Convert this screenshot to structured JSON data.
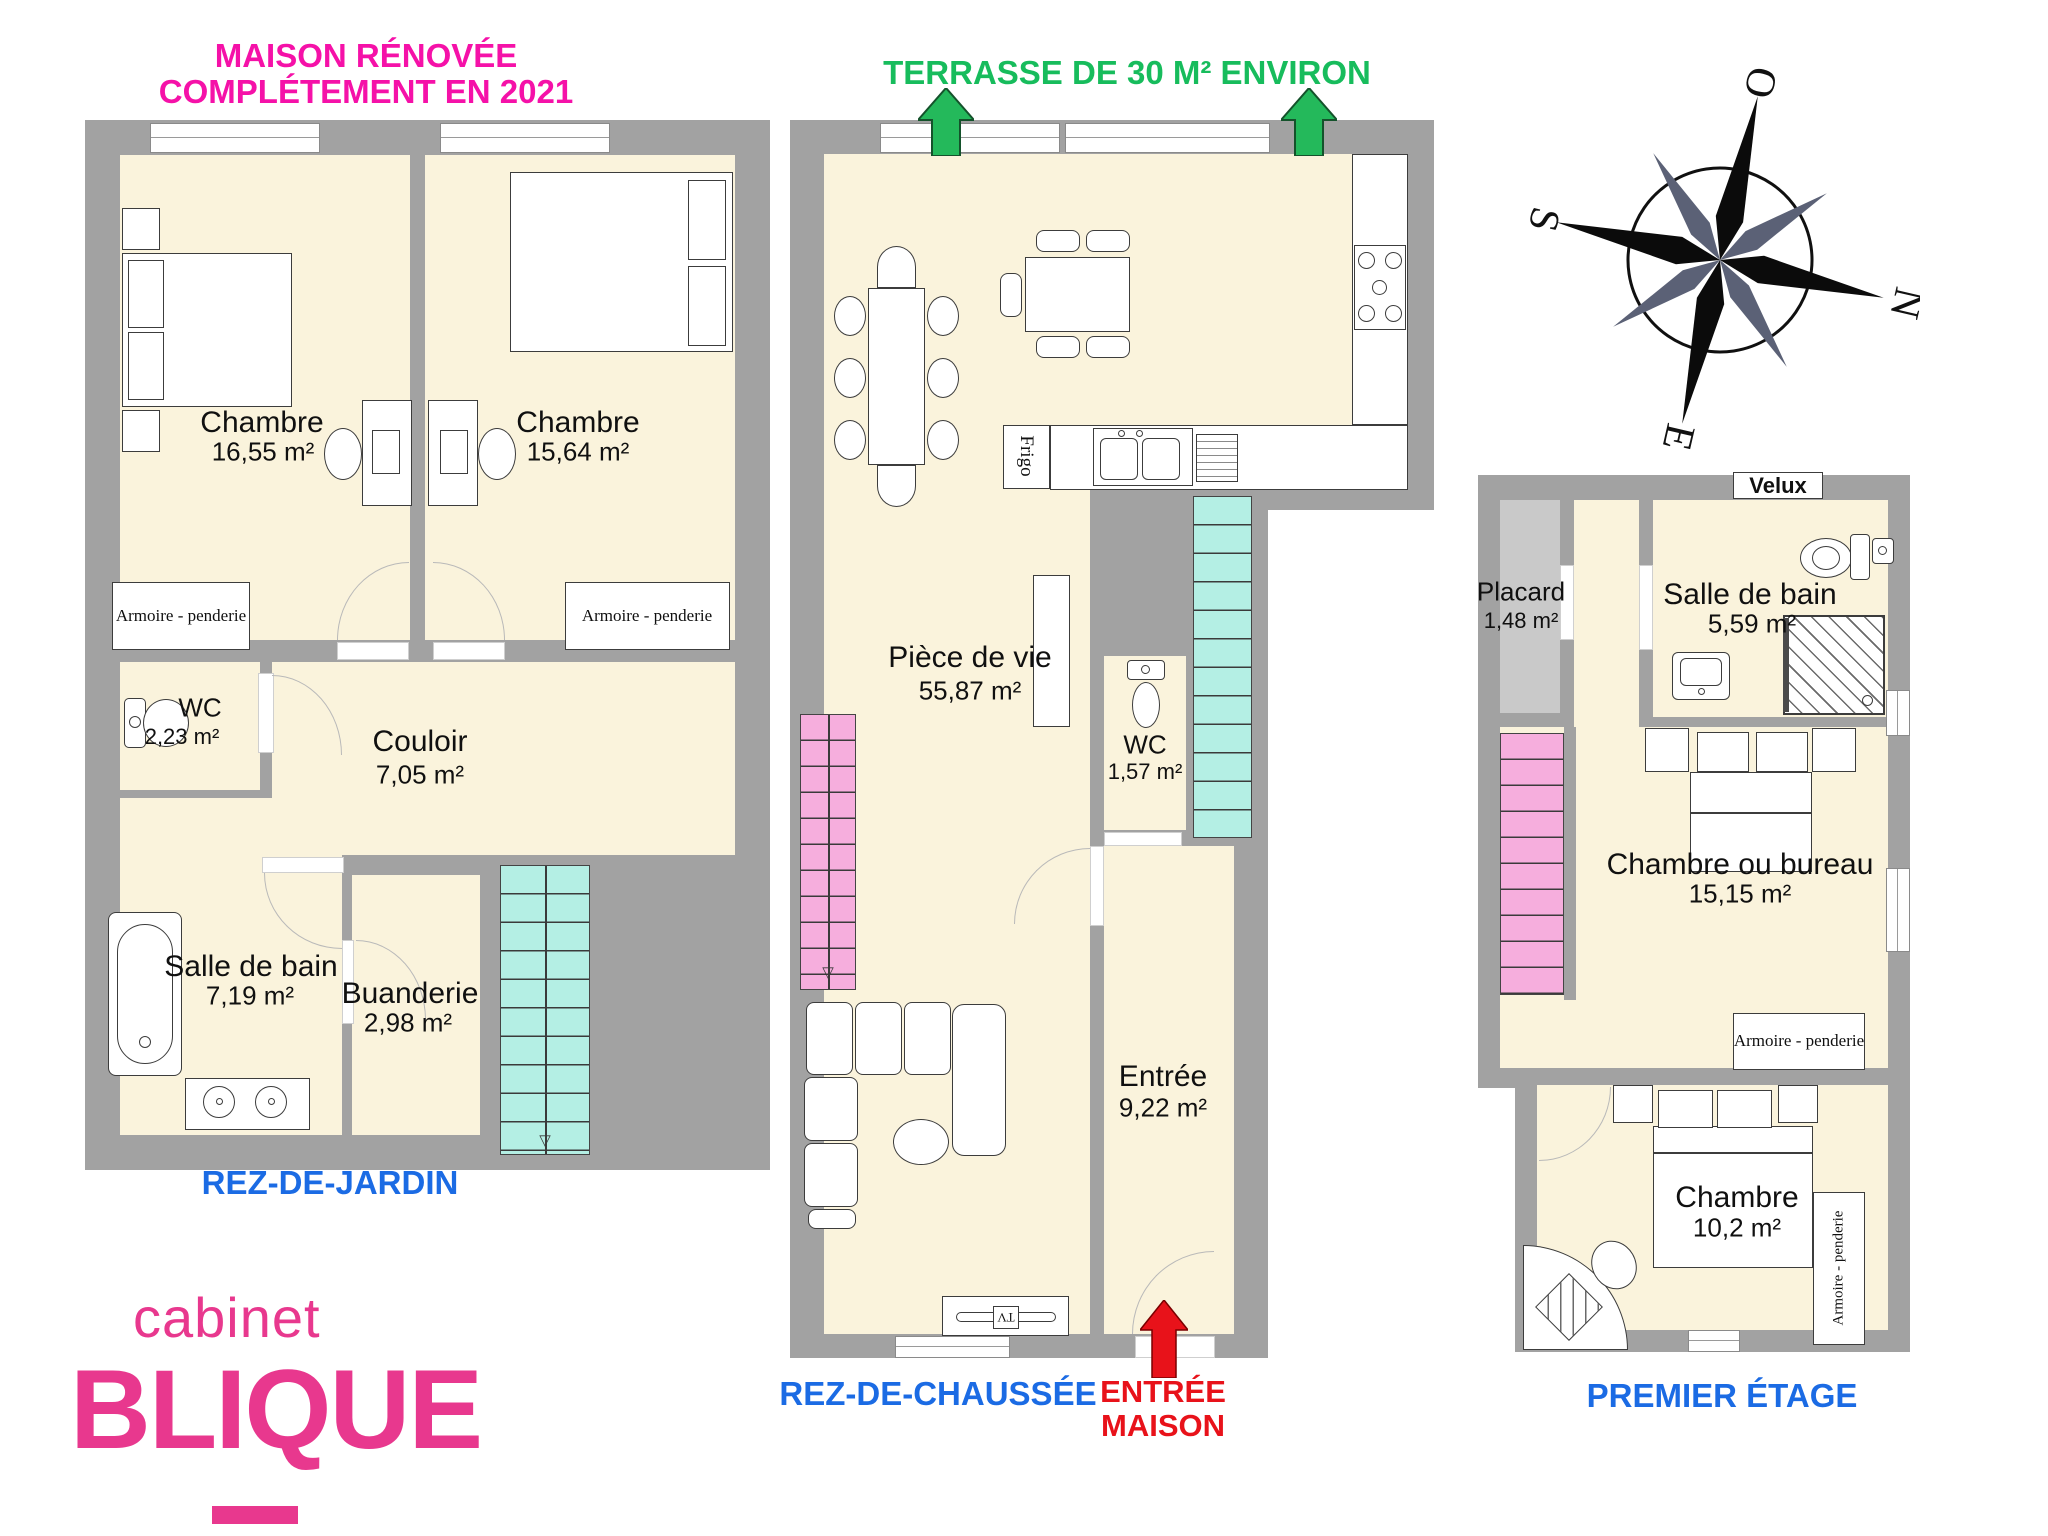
{
  "titles": {
    "renovation_line1": "MAISON RÉNOVÉE",
    "renovation_line2": "COMPLÉTEMENT EN 2021",
    "terrace": "TERRASSE DE 30 M² ENVIRON",
    "entrance_line1": "ENTRÉE",
    "entrance_line2": "MAISON"
  },
  "branding": {
    "line1": "cabinet",
    "line2": "BLIQUE"
  },
  "compass": {
    "north": "N",
    "east": "E",
    "south": "S",
    "west": "O"
  },
  "colors": {
    "magenta": "#F511A8",
    "green": "#17BC5C",
    "blue": "#1B6BE4",
    "red": "#E8121A",
    "logo_pink": "#E8388E",
    "teal_stairs": "#B4EFE4",
    "pink_stairs": "#F6AEDD",
    "wall_gray": "#A2A2A2",
    "floor_cream": "#FAF3DC",
    "placard_gray": "#C9C9C9"
  },
  "garden_level": {
    "label": "REZ-DE-JARDIN",
    "bedroom1": {
      "name": "Chambre",
      "area": "16,55 m²"
    },
    "bedroom2": {
      "name": "Chambre",
      "area": "15,64 m²"
    },
    "wc": {
      "name": "WC",
      "area": "2,23 m²"
    },
    "hallway": {
      "name": "Couloir",
      "area": "7,05 m²"
    },
    "bathroom": {
      "name": "Salle de bain",
      "area": "7,19 m²"
    },
    "laundry": {
      "name": "Buanderie",
      "area": "2,98 m²"
    },
    "closet1": "Armoire - penderie",
    "closet2": "Armoire - penderie"
  },
  "ground_level": {
    "label": "REZ-DE-CHAUSSÉE",
    "living": {
      "name": "Pièce de vie",
      "area": "55,87 m²"
    },
    "wc": {
      "name": "WC",
      "area": "1,57 m²"
    },
    "entry": {
      "name": "Entrée",
      "area": "9,22 m²"
    },
    "fridge": "Frigo",
    "tv": "TV"
  },
  "first_level": {
    "label": "PREMIER ÉTAGE",
    "velux": "Velux",
    "closet_small": {
      "name": "Placard",
      "area": "1,48 m²"
    },
    "bathroom": {
      "name": "Salle de bain",
      "area": "5,59 m²"
    },
    "bedroom_office": {
      "name": "Chambre ou bureau",
      "area": "15,15 m²"
    },
    "bedroom": {
      "name": "Chambre",
      "area": "10,2 m²"
    },
    "closet1": "Armoire - penderie",
    "closet2": "Armoire - penderie"
  },
  "icons": {
    "down_arrow": "▽"
  }
}
